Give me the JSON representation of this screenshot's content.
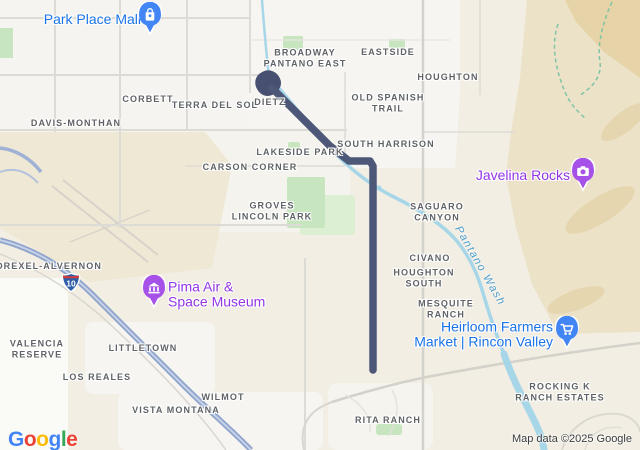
{
  "map": {
    "attribution": "Map data ©2025 Google",
    "logo": {
      "letters": [
        {
          "ch": "G",
          "color": "#4285F4"
        },
        {
          "ch": "o",
          "color": "#EA4335"
        },
        {
          "ch": "o",
          "color": "#FBBC05"
        },
        {
          "ch": "g",
          "color": "#4285F4"
        },
        {
          "ch": "l",
          "color": "#34A853"
        },
        {
          "ch": "e",
          "color": "#EA4335"
        }
      ]
    },
    "colors": {
      "poi_blue": "#1a73e8",
      "poi_purple": "#9334e6",
      "pin_blue": "#4285f4",
      "pin_purple": "#a652e8",
      "route": "#4d5777",
      "water": "#a6d6e7",
      "water_label": "#4d9bc9",
      "highway": "#9fb1d4",
      "park_green": "#c7e6bf",
      "terrain_tan": "#e6d3a8"
    },
    "shield": {
      "label": "10"
    },
    "water_label": {
      "text": "Pantano Wash"
    },
    "pois": {
      "park_place_mall": {
        "lines": [
          "Park Place Mall"
        ],
        "icon": "mall-icon"
      },
      "javelina_rocks": {
        "lines": [
          "Javelina Rocks"
        ],
        "icon": "camera-icon"
      },
      "pima_air_space_museum": {
        "lines": [
          "Pima Air &",
          "Space Museum"
        ],
        "icon": "museum-icon"
      },
      "heirloom_farmers_market": {
        "lines": [
          "Heirloom Farmers",
          "Market | Rincon Valley"
        ],
        "icon": "cart-icon"
      }
    },
    "area_labels": {
      "corbett": {
        "lines": [
          "CORBETT"
        ]
      },
      "terra_del_sol": {
        "lines": [
          "TERRA DEL SOL"
        ]
      },
      "dietz": {
        "lines": [
          "DIETZ"
        ]
      },
      "davis_monthan": {
        "lines": [
          "DAVIS-MONTHAN"
        ]
      },
      "broadway_pantano_east": {
        "lines": [
          "BROADWAY",
          "PANTANO EAST"
        ]
      },
      "eastside": {
        "lines": [
          "EASTSIDE"
        ]
      },
      "houghton": {
        "lines": [
          "HOUGHTON"
        ]
      },
      "old_spanish_trail": {
        "lines": [
          "OLD SPANISH",
          "TRAIL"
        ]
      },
      "lakeside_park": {
        "lines": [
          "LAKESIDE PARK"
        ]
      },
      "south_harrison": {
        "lines": [
          "SOUTH HARRISON"
        ]
      },
      "carson_corner": {
        "lines": [
          "CARSON CORNER"
        ]
      },
      "saguaro_canyon": {
        "lines": [
          "SAGUARO",
          "CANYON"
        ]
      },
      "groves_lincoln_park": {
        "lines": [
          "GROVES",
          "LINCOLN PARK"
        ]
      },
      "drexel_alvernon": {
        "lines": [
          "DREXEL-ALVERNON"
        ]
      },
      "civano": {
        "lines": [
          "CIVANO"
        ]
      },
      "houghton_south": {
        "lines": [
          "HOUGHTON",
          "SOUTH"
        ]
      },
      "mesquite_ranch": {
        "lines": [
          "MESQUITE",
          "RANCH"
        ]
      },
      "valencia_reserve": {
        "lines": [
          "VALENCIA",
          "RESERVE"
        ]
      },
      "littletown": {
        "lines": [
          "LITTLETOWN"
        ]
      },
      "los_reales": {
        "lines": [
          "LOS REALES"
        ]
      },
      "wilmot": {
        "lines": [
          "WILMOT"
        ]
      },
      "vista_montana": {
        "lines": [
          "VISTA MONTANA"
        ]
      },
      "rita_ranch": {
        "lines": [
          "RITA RANCH"
        ]
      },
      "rocking_k_ranch_estates": {
        "lines": [
          "ROCKING K",
          "RANCH ESTATES"
        ]
      }
    }
  }
}
